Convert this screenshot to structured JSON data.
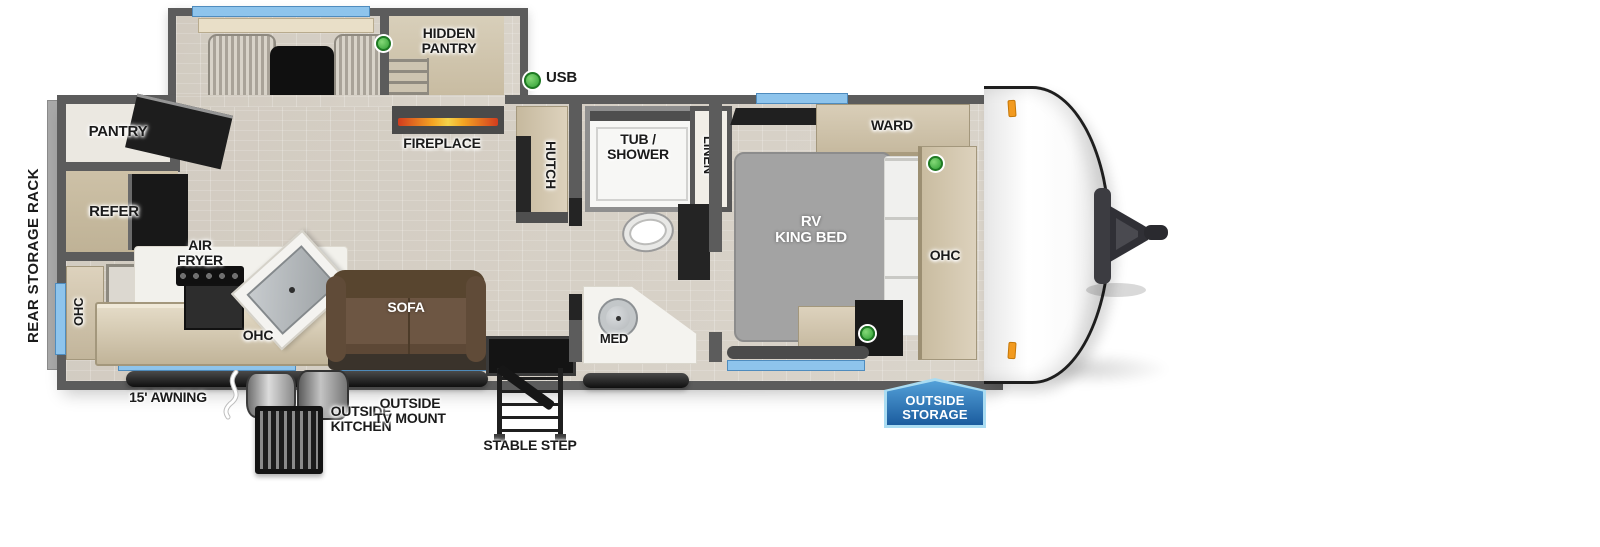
{
  "title": "Travel trailer floorplan",
  "legend": {
    "usb": "USB"
  },
  "labels": {
    "rear_storage_rack": "REAR STORAGE RACK",
    "pantry": "PANTRY",
    "refer": "REFER",
    "ohc_left": "OHC",
    "air_fryer": "AIR\nFRYER",
    "ohc_kitchen": "OHC",
    "dinette": "DINETTE",
    "hidden_pantry": "HIDDEN\nPANTRY",
    "fireplace": "FIREPLACE",
    "hutch": "HUTCH",
    "sofa": "SOFA",
    "tub_shower": "TUB /\nSHOWER",
    "linen": "LINEN",
    "med": "MED",
    "rv_king_bed": "RV\nKING BED",
    "ward": "WARD",
    "ohc_bedroom": "OHC",
    "awning": "15' AWNING",
    "outside_kitchen": "OUTSIDE\nKITCHEN",
    "outside_tv_mount": "OUTSIDE\nTV MOUNT",
    "stable_step": "STABLE STEP",
    "outside_storage": "OUTSIDE\nSTORAGE"
  },
  "colors": {
    "wall_gray": "#5c5c5c",
    "floor_tan": "#d8d2c8",
    "cabinet_tan": "#cfc4ae",
    "window_blue": "#8ec4ec",
    "usb_green": "#3fae3f",
    "marker_orange": "#f29a1f",
    "badge_blue_dark": "#1b5c9e",
    "badge_blue_light": "#53a0d8",
    "badge_border": "#aadcf2",
    "sofa_brown": "#6a5343",
    "bed_gray": "#a3a3a3"
  }
}
